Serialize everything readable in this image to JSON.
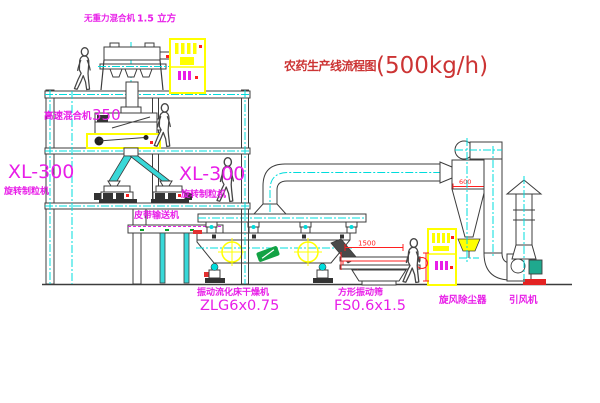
{
  "title": {
    "name": "农药生产线流程图",
    "capacity": "(500kg/h)"
  },
  "labels": {
    "gravity_mixer_name": "无重力混合机",
    "gravity_mixer_capacity": "1.5 立方",
    "high_speed_mixer_name": "高速混合机",
    "high_speed_mixer_model": "350",
    "granulator_left_model": "XL-300",
    "granulator_left_name": "旋转制粒机",
    "granulator_right_model": "XL-300",
    "granulator_right_name": "旋转制粒机",
    "belt_conveyor_name": "皮带输送机",
    "dryer_name": "振动流化床干燥机",
    "dryer_model": "ZLG6x0.75",
    "screen_name": "方形振动筛",
    "screen_model": "FS0.6x1.5",
    "cyclone_name": "旋风除尘器",
    "fan_name": "引风机"
  },
  "dimensions": {
    "cyclone_outlet": "600",
    "screen_length": "1500"
  },
  "colors": {
    "label_magenta": "#e81ee8",
    "title_red": "#cc3434",
    "dimension_red": "#ff1f1f",
    "highlight_yellow": "#ffff00",
    "centerline_cyan": "#00dcdc",
    "outline_dark": "#3c3c3c",
    "chute_cyan": "#39d8d8",
    "motor_teal": "#1fa98e",
    "logo_green": "#12a244",
    "fan_base_red": "#e32222"
  }
}
